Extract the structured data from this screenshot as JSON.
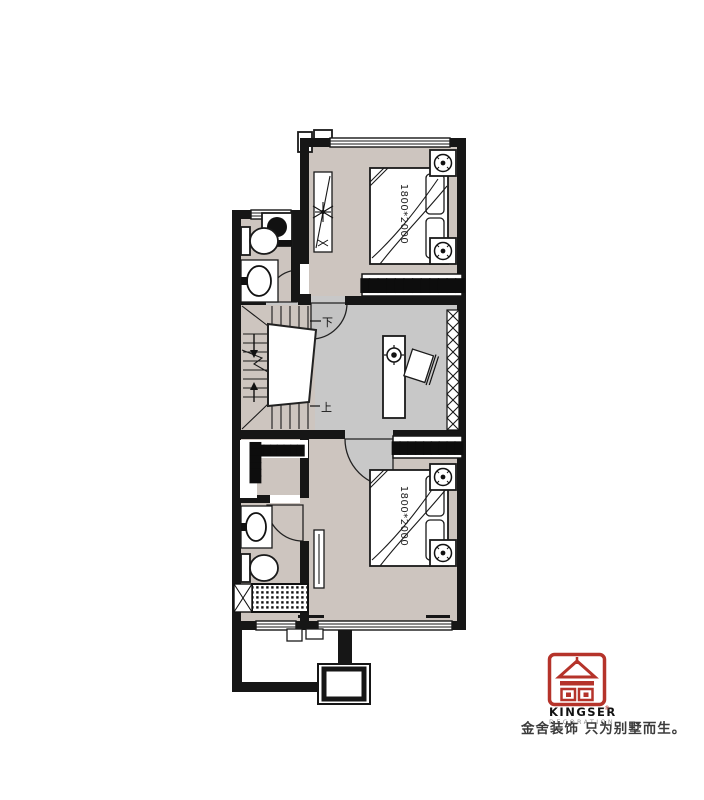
{
  "plan": {
    "bedroom_top": {
      "bed_size": "1800*2000",
      "label_bar": "████████████"
    },
    "bedroom_bottom": {
      "bed_size": "1800*2000",
      "label_bar": "█████████"
    },
    "stairs": {
      "down_label": "下",
      "up_label": "上"
    },
    "closet": {
      "label_horizontal": "████████",
      "label_vertical": "██████"
    }
  },
  "branding": {
    "name": "KINGSER",
    "registered": "®",
    "subtitle": "DECORATION",
    "tagline": "金舍装饰 只为别墅而生。",
    "colors": {
      "red": "#b5332a",
      "gray": "#8f8f8f",
      "tagline_text": "#3b3b3b"
    }
  },
  "palette": {
    "wall": "#161616",
    "room_floor": "#cdc5bf",
    "hall_floor": "#c8c8c8",
    "background": "#ffffff"
  }
}
